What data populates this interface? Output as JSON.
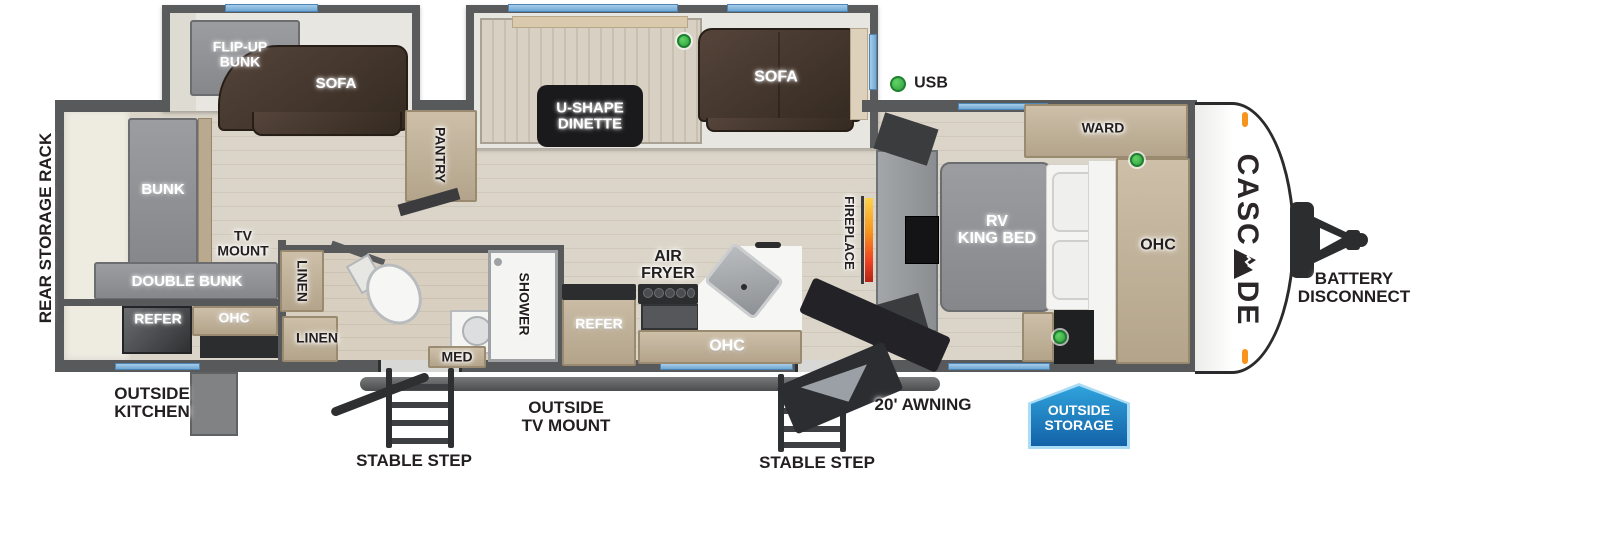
{
  "title": "Cascade travel trailer floor plan",
  "brand": {
    "part1": "CASC",
    "part2": "DE",
    "name": "CASCADE"
  },
  "colors": {
    "wall": "#58595b",
    "window_blue": "#7fb2d9",
    "usb_green": "#3eb549",
    "accent_orange": "#f7941d",
    "flame_top": "#ffd24a",
    "flame_bottom": "#b32317",
    "badge_blue_light": "#2fa3dc",
    "badge_blue_dark": "#1462a8",
    "sofa_brown": "#443528",
    "cabinet_tan": "#c2b49e",
    "furniture_gray": "#8e9093"
  },
  "rooms": {
    "rear": {
      "storage_rack": "REAR STORAGE RACK",
      "flip_up_bunk_l1": "FLIP-UP",
      "flip_up_bunk_l2": "BUNK",
      "sofa": "SOFA",
      "bunk": "BUNK",
      "tv_mount_l1": "TV",
      "tv_mount_l2": "MOUNT",
      "double_bunk": "DOUBLE BUNK",
      "refer": "REFER",
      "ohc": "OHC"
    },
    "bath": {
      "linen_upper": "LINEN",
      "linen_lower": "LINEN",
      "shower": "SHOWER",
      "med": "MED"
    },
    "living": {
      "pantry": "PANTRY",
      "dinette_l1": "U-SHAPE",
      "dinette_l2": "DINETTE",
      "sofa": "SOFA",
      "fireplace": "FIREPLACE"
    },
    "kitchen": {
      "refer": "REFER",
      "air_fryer_l1": "AIR",
      "air_fryer_l2": "FRYER",
      "ohc": "OHC"
    },
    "bedroom": {
      "bed_l1": "RV",
      "bed_l2": "KING BED",
      "ward": "WARD",
      "ohc": "OHC"
    }
  },
  "exterior": {
    "usb": "USB",
    "outside_kitchen_l1": "OUTSIDE",
    "outside_kitchen_l2": "KITCHEN",
    "stable_step_left": "STABLE STEP",
    "outside_tv_mount_l1": "OUTSIDE",
    "outside_tv_mount_l2": "TV MOUNT",
    "stable_step_right": "STABLE STEP",
    "awning": "20' AWNING",
    "outside_storage_l1": "OUTSIDE",
    "outside_storage_l2": "STORAGE",
    "battery_l1": "BATTERY",
    "battery_l2": "DISCONNECT"
  },
  "icons": {
    "mountain": "mountain-icon",
    "usb_port": "usb-port-dot",
    "marker_light": "marker-light"
  }
}
